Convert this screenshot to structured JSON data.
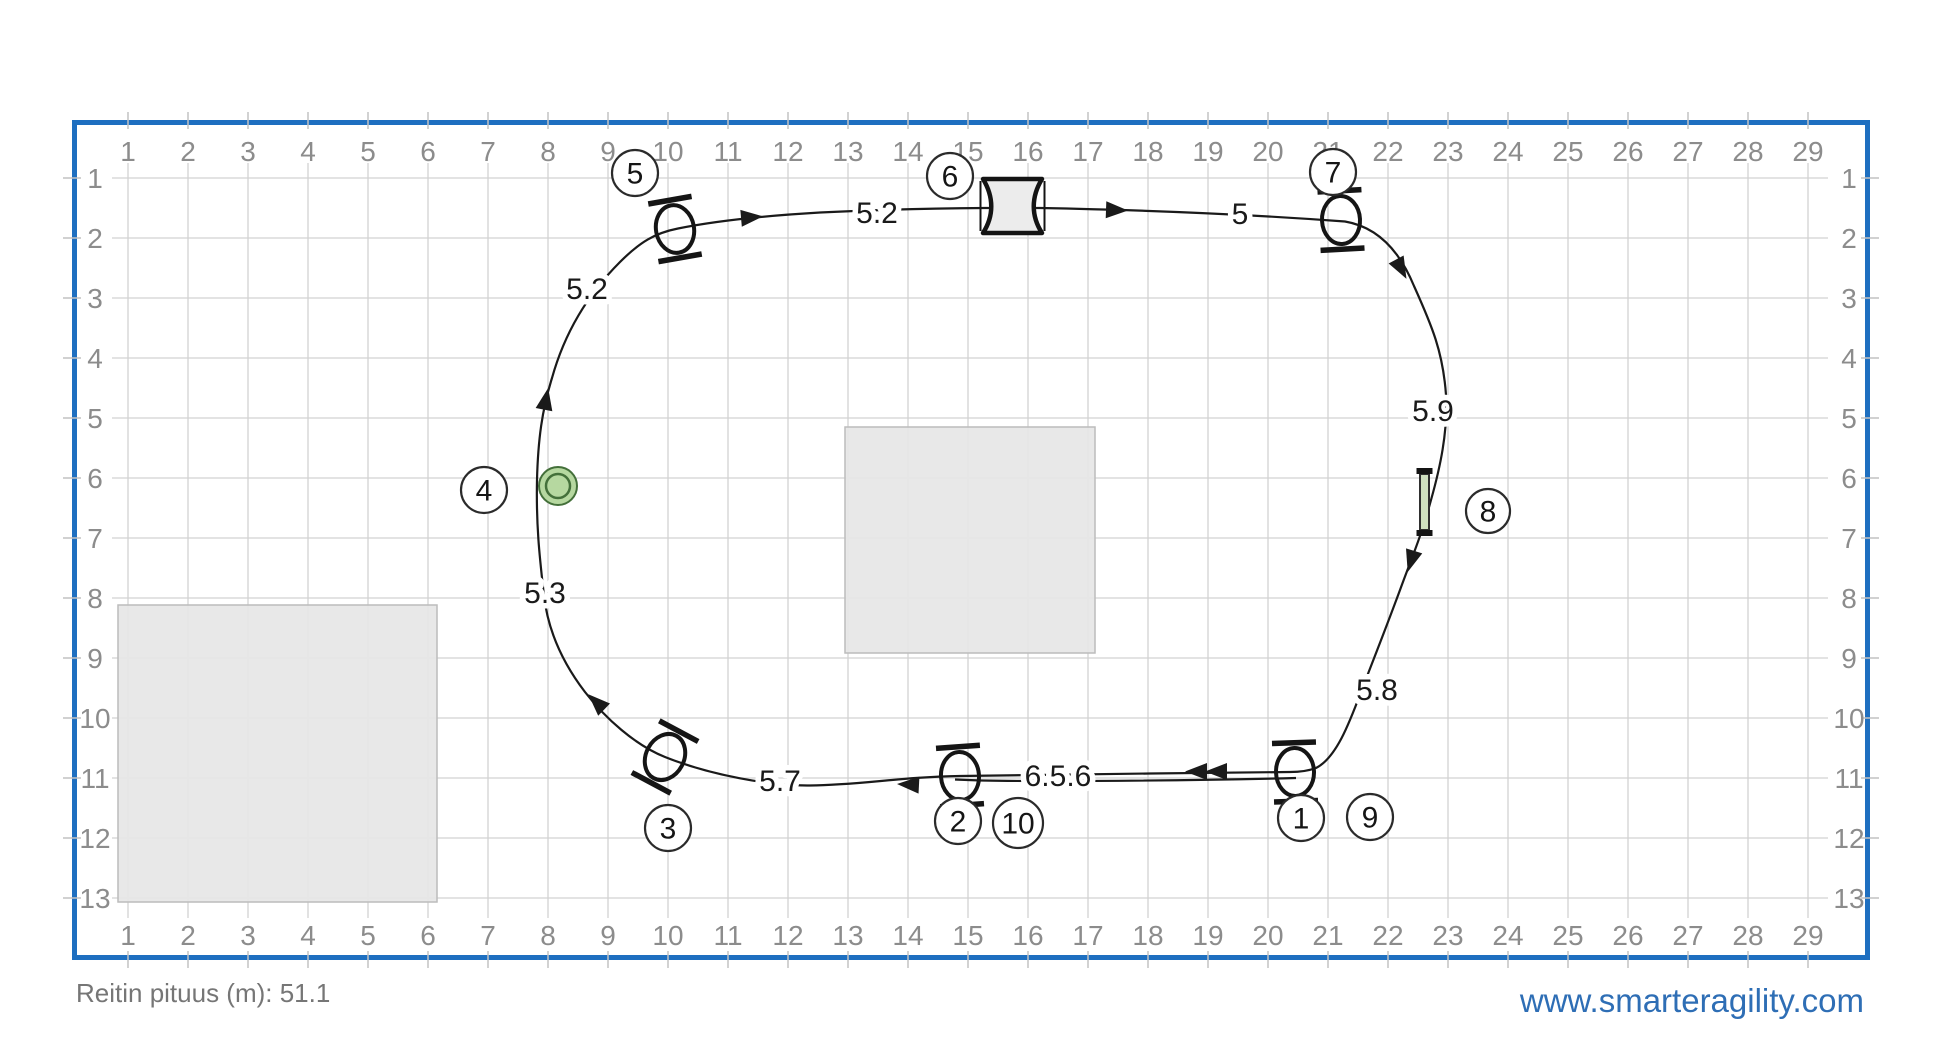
{
  "footer": {
    "course_length": "Reitin pituus (m): 51.1",
    "website": "www.smarteragility.com"
  },
  "colors": {
    "frame": "#1e6fc0",
    "grid_line": "#d2d2d2",
    "tick": "#c2c2c2",
    "axis_text": "#8c8c8c",
    "route": "#1a1a1a",
    "area_fill": "#e6e6e6",
    "area_border": "#bcbcbc",
    "obstacle_stroke": "#151515",
    "wall_fill": "#cfe0bf",
    "marker_fill": "#b6d8a0",
    "marker_ring": "#44703a",
    "website_blue": "#2e6eb5",
    "length_gray": "#767676"
  },
  "grid": {
    "cols": 29,
    "rows": 13,
    "origin_x": 128,
    "origin_y": 178,
    "cell": 60,
    "col_labels": [
      "1",
      "2",
      "3",
      "4",
      "5",
      "6",
      "7",
      "8",
      "9",
      "10",
      "11",
      "12",
      "13",
      "14",
      "15",
      "16",
      "17",
      "18",
      "19",
      "20",
      "21",
      "22",
      "23",
      "24",
      "25",
      "26",
      "27",
      "28",
      "29"
    ],
    "row_labels": [
      "1",
      "2",
      "3",
      "4",
      "5",
      "6",
      "7",
      "8",
      "9",
      "10",
      "11",
      "12",
      "13"
    ]
  },
  "frame": {
    "x": 74.5,
    "y": 122.5,
    "w": 1793,
    "h": 835,
    "stroke_width": 5
  },
  "areas": [
    {
      "x": 845,
      "y": 427,
      "w": 250,
      "h": 226
    },
    {
      "x": 118,
      "y": 605,
      "w": 319,
      "h": 297
    }
  ],
  "route": {
    "stroke_width": 2.2,
    "main_d": "M 1290 772 L 1150 773.5 C 1050 775 1000 775.5 960 776 C 900 777 860 785 810 785.5 C 770 786 710 775 665 757 C 635 745 605 718 585 692 C 562 662 548 630 544 596 C 540 560 536 528 537 480 C 538 440 542 410 552 378 C 564 335 586 296 620 262 C 640 242 655 233 678 228.5 C 715 221 760 216 820 212.5 C 870 210 920 208.5 985 208 L 1040 208 C 1120 209.5 1230 213 1345 221.5 C 1378 227 1400 252 1414 286 C 1432 326 1443 352 1446 395 C 1448 432 1440 468 1431 500 C 1421 537 1412 557 1400 590 C 1386 628 1374 658 1361 692 C 1349 724 1336 758 1316 768 C 1308 771 1300 772 1290 772",
    "second_d": "M 1296 778 C 1200 780.5 1100 781 1040 781 C 1000 781 975 780.5 955 779.5",
    "arrows": [
      {
        "x": 762,
        "y": 216.5,
        "a": -5,
        "double": false
      },
      {
        "x": 1127,
        "y": 210.5,
        "a": 2,
        "double": false
      },
      {
        "x": 1406,
        "y": 278,
        "a": 62,
        "double": false
      },
      {
        "x": 1408,
        "y": 571,
        "a": 107,
        "double": false
      },
      {
        "x": 1186,
        "y": 771.5,
        "a": 180,
        "double": true
      },
      {
        "x": 898,
        "y": 784,
        "a": 183,
        "double": false
      },
      {
        "x": 589,
        "y": 695,
        "a": 224,
        "double": false
      },
      {
        "x": 548,
        "y": 389,
        "a": -79,
        "double": false
      }
    ]
  },
  "jumps": [
    {
      "id": "jump-1",
      "x": 1295,
      "y": 772,
      "angle": -2
    },
    {
      "id": "jump-2",
      "x": 960,
      "y": 776,
      "angle": -4
    },
    {
      "id": "jump-3",
      "x": 665,
      "y": 757,
      "angle": 28
    },
    {
      "id": "jump-5",
      "x": 675,
      "y": 229,
      "angle": -10
    },
    {
      "id": "jump-7",
      "x": 1341,
      "y": 220,
      "angle": -3
    }
  ],
  "tunnel": {
    "cx": 1012.5,
    "cy": 206,
    "left": 983,
    "right": 1042,
    "top": 179,
    "bottom": 233
  },
  "wall": {
    "x": 1420,
    "y": 474,
    "w": 9,
    "h": 56
  },
  "marker": {
    "cx": 558,
    "cy": 486,
    "r_outer": 19,
    "r_inner": 12
  },
  "obstacle_numbers": [
    {
      "n": "1",
      "x": 1301,
      "y": 818,
      "r": 23
    },
    {
      "n": "2",
      "x": 958,
      "y": 821,
      "r": 23
    },
    {
      "n": "3",
      "x": 668,
      "y": 828,
      "r": 23
    },
    {
      "n": "4",
      "x": 484,
      "y": 490,
      "r": 23
    },
    {
      "n": "5",
      "x": 635,
      "y": 173,
      "r": 23
    },
    {
      "n": "6",
      "x": 950,
      "y": 176,
      "r": 23
    },
    {
      "n": "7",
      "x": 1333,
      "y": 172,
      "r": 23
    },
    {
      "n": "8",
      "x": 1488,
      "y": 511,
      "r": 22
    },
    {
      "n": "9",
      "x": 1370,
      "y": 817,
      "r": 23
    },
    {
      "n": "10",
      "x": 1018,
      "y": 823,
      "r": 25
    }
  ],
  "distance_labels": [
    {
      "t": "5.2",
      "x": 587,
      "y": 289
    },
    {
      "t": "5.2",
      "x": 877,
      "y": 213
    },
    {
      "t": "5",
      "x": 1240,
      "y": 214
    },
    {
      "t": "5.9",
      "x": 1433,
      "y": 411
    },
    {
      "t": "5.8",
      "x": 1377,
      "y": 690
    },
    {
      "t": "6.5.6",
      "x": 1058,
      "y": 776
    },
    {
      "t": "5.7",
      "x": 780,
      "y": 781
    },
    {
      "t": "5.3",
      "x": 545,
      "y": 593
    }
  ]
}
